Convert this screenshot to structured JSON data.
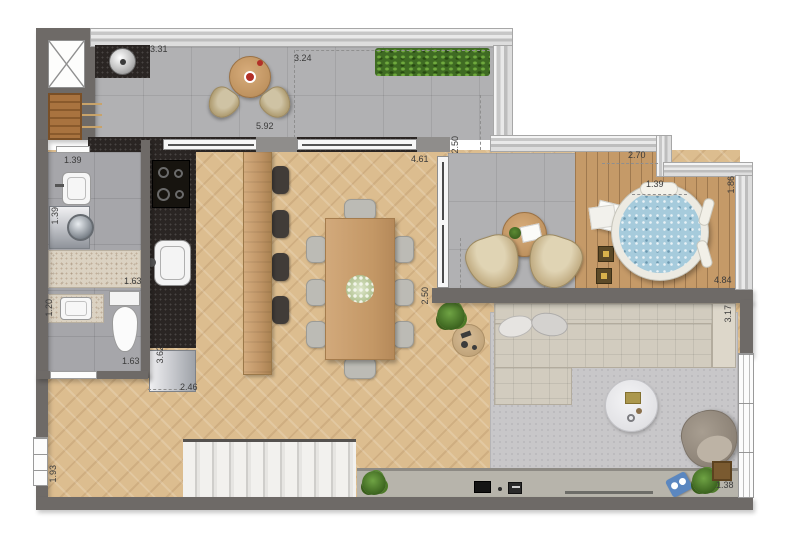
{
  "labels": {
    "grill_width": "3.31",
    "terrace_depth": "3.24",
    "terrace_width": "5.92",
    "terrace_opening": "2.50",
    "dining_width": "4.61",
    "deck_top_width": "2.70",
    "spa_seat_width": "1.39",
    "deck_right_depth": "1.86",
    "deck_width": "4.84",
    "living_opening": "2.50",
    "living_depth": "3.17",
    "laundry_sink_width": "1.39",
    "laundry_depth": "1.39",
    "laundry_counter_width": "1.63",
    "bath_vanity_width": "1.20",
    "bath_width": "1.63",
    "kitchen_run_depth": "3.62",
    "hall_width": "2.46",
    "hall_depth": "1.93",
    "console_width": "1.38"
  },
  "colors": {
    "wall": "#6e6a67",
    "railing": "#d6d6d6",
    "terrace_tile": "#b1b1b3",
    "wood_floor": "#dcbd8f",
    "deck_wood": "#c59a68",
    "dark_counter": "#2a2523",
    "granite_counter": "#dbd2c2",
    "rug": "#c8c7c9",
    "spa_water": "#a6cbdc",
    "grass": "#3f6b23",
    "label_text": "#3b3b3b"
  }
}
